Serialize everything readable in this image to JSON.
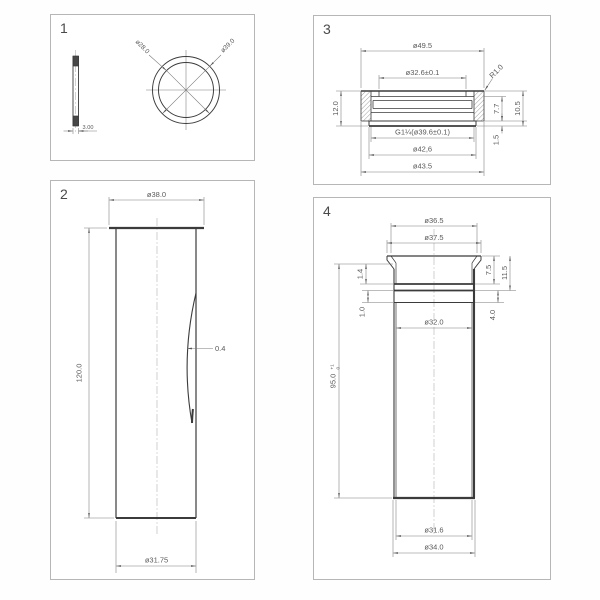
{
  "sheet": {
    "panels": {
      "p1": {
        "number": "1",
        "dims": {
          "inner_diameter": "ø28.0",
          "outer_diameter": "ø39.0",
          "thickness": "3.00"
        }
      },
      "p2": {
        "number": "2",
        "dims": {
          "top_diameter": "ø38.0",
          "length": "120.0",
          "wall_offset": "0.4",
          "bottom_diameter": "ø31.75"
        }
      },
      "p3": {
        "number": "3",
        "dims": {
          "flange_diameter": "ø49.5",
          "bore_diameter": "ø32.6±0.1",
          "corner_radius": "R1.0",
          "total_height": "12.0",
          "inner_height": "7.7",
          "outer_height": "10.5",
          "lip_height": "1.5",
          "thread": "G1¼(ø39.6±0.1)",
          "skirt_diameter": "ø42,6",
          "base_diameter": "ø43.5"
        }
      },
      "p4": {
        "number": "4",
        "dims": {
          "top_inner_diameter": "ø36.5",
          "top_outer_diameter": "ø37.5",
          "rim_depth": "7.5",
          "head_depth": "11.5",
          "groove_width": "1.4",
          "step_width": "1.0",
          "band_height": "4.0",
          "bore_diameter": "ø32.0",
          "length": "95.0",
          "length_tol_upper": "+1",
          "length_tol_lower": "0",
          "bottom_inner_diameter": "ø31.6",
          "bottom_outer_diameter": "ø34.0"
        }
      }
    }
  }
}
